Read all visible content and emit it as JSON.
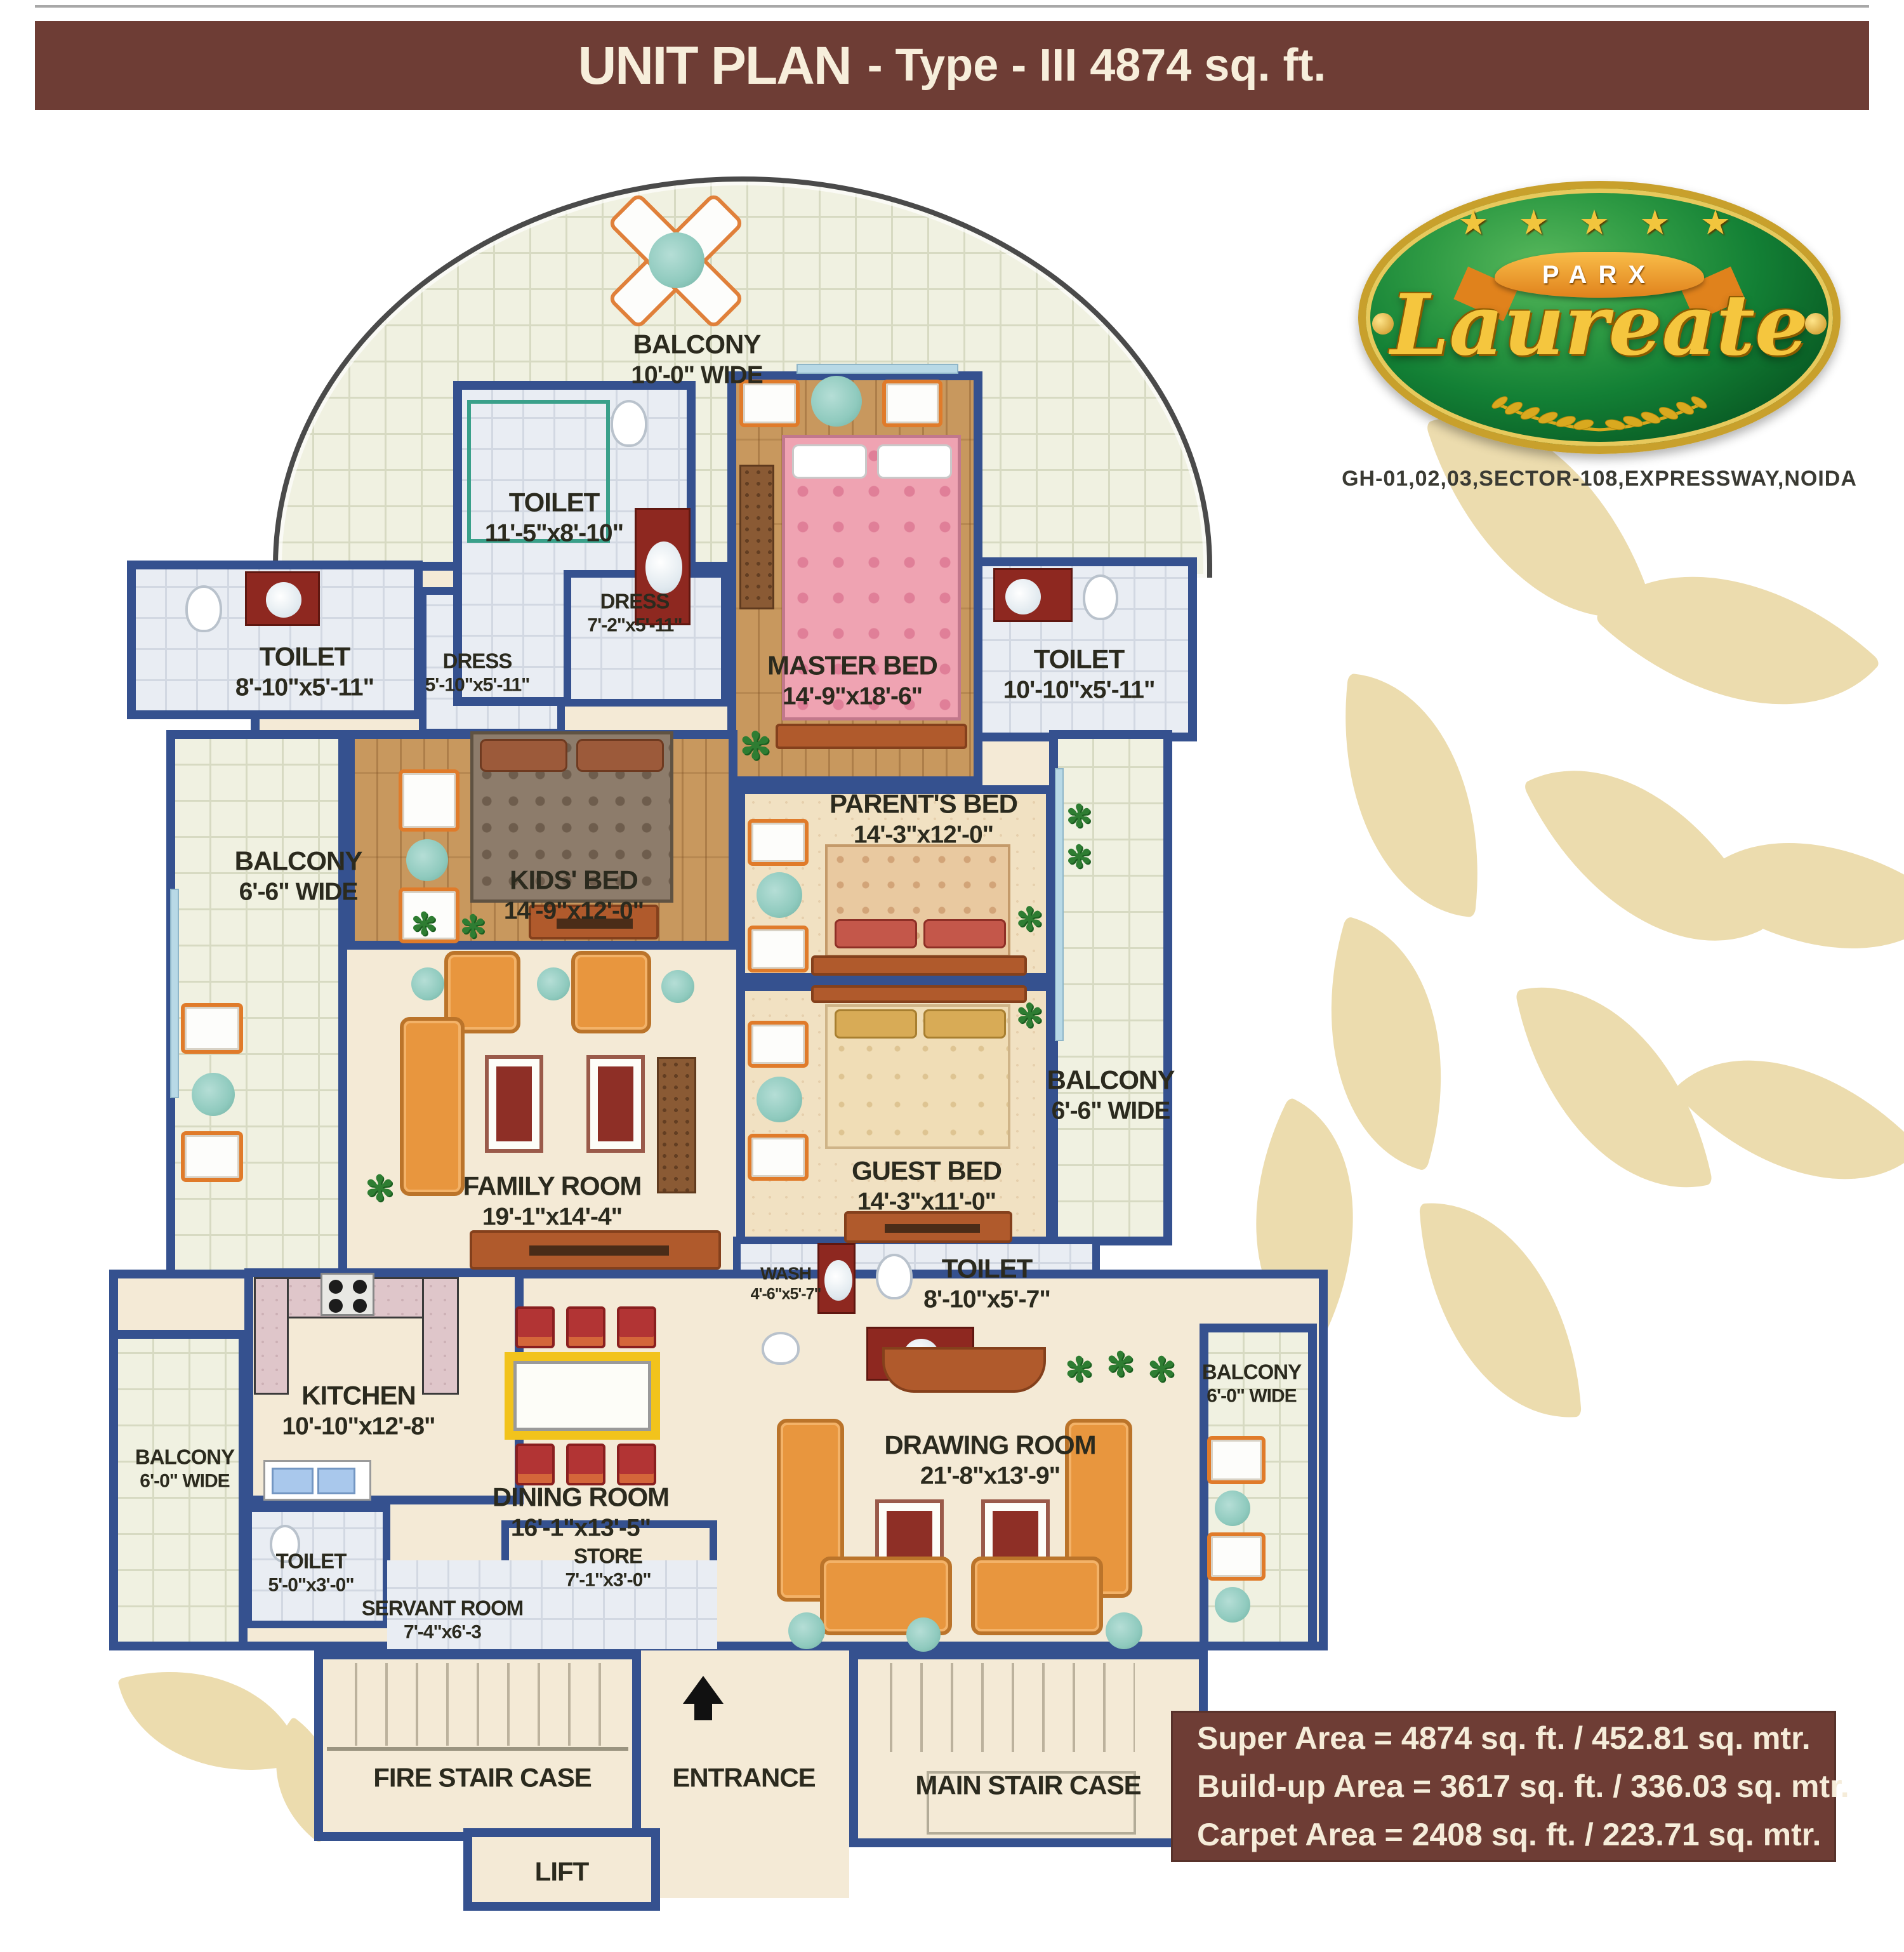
{
  "header": {
    "title_main": "UNIT PLAN",
    "title_rest": "- Type - III 4874 sq. ft."
  },
  "logo": {
    "stars": "★ ★ ★ ★ ★",
    "brand_top": "PARX",
    "brand_main": "Laureate",
    "address": "GH-01,02,03,SECTOR-108,EXPRESSWAY,NOIDA"
  },
  "info": {
    "lines": [
      "Super Area = 4874 sq. ft. / 452.81 sq. mtr.",
      "Build-up Area = 3617 sq. ft. / 336.03 sq. mtr.",
      "Carpet Area = 2408 sq. ft. / 223.71 sq. mtr."
    ]
  },
  "icons": {
    "plant": "✻",
    "star": "★"
  },
  "palette": {
    "bar_maroon": "#6e3d35",
    "wall_blue": "#35518f",
    "tile": "#f0f1e1",
    "cream": "#f4ead6",
    "wood": "#c8985e",
    "carpet": "#f1e1c2",
    "bath_tile": "#e9edf3",
    "leaf_watermark": "#ecdcae",
    "logo_green": "#117a2e",
    "logo_gold": "#f2c53d",
    "accent_orange": "#e8963e",
    "accent_red": "#b23434",
    "label_ink": "#2b2a1e"
  },
  "rooms": [
    {
      "name": "BALCONY",
      "dims": "10'-0\" WIDE"
    },
    {
      "name": "TOILET",
      "dims": "11'-5\"x8'-10\""
    },
    {
      "name": "DRESS",
      "dims": "7'-2\"x5'-11\""
    },
    {
      "name": "MASTER BED",
      "dims": "14'-9\"x18'-6\""
    },
    {
      "name": "TOILET",
      "dims": "8'-10\"x5'-11\""
    },
    {
      "name": "DRESS",
      "dims": "5'-10\"x5'-11\""
    },
    {
      "name": "TOILET",
      "dims": "10'-10\"x5'-11\""
    },
    {
      "name": "BALCONY",
      "dims": "6'-6\" WIDE"
    },
    {
      "name": "KIDS' BED",
      "dims": "14'-9\"x12'-0\""
    },
    {
      "name": "PARENT'S BED",
      "dims": "14'-3\"x12'-0\""
    },
    {
      "name": "GUEST BED",
      "dims": "14'-3\"x11'-0\""
    },
    {
      "name": "BALCONY",
      "dims": "6'-6\" WIDE"
    },
    {
      "name": "FAMILY ROOM",
      "dims": "19'-1\"x14'-4\""
    },
    {
      "name": "WASH",
      "dims": "4'-6\"x5'-7\""
    },
    {
      "name": "TOILET",
      "dims": "8'-10\"x5'-7\""
    },
    {
      "name": "KITCHEN",
      "dims": "10'-10\"x12'-8\""
    },
    {
      "name": "BALCONY",
      "dims": "6'-0\" WIDE"
    },
    {
      "name": "DINING ROOM",
      "dims": "16'-1\"x13'-5\""
    },
    {
      "name": "DRAWING ROOM",
      "dims": "21'-8\"x13'-9\""
    },
    {
      "name": "BALCONY",
      "dims": "6'-0\" WIDE"
    },
    {
      "name": "TOILET",
      "dims": "5'-0\"x3'-0\""
    },
    {
      "name": "STORE",
      "dims": "7'-1\"x3'-0\""
    },
    {
      "name": "SERVANT ROOM",
      "dims": "7'-4\"x6'-3"
    },
    {
      "name": "FIRE STAIR CASE",
      "dims": ""
    },
    {
      "name": "ENTRANCE",
      "dims": ""
    },
    {
      "name": "MAIN STAIR CASE",
      "dims": ""
    },
    {
      "name": "LIFT",
      "dims": ""
    }
  ]
}
